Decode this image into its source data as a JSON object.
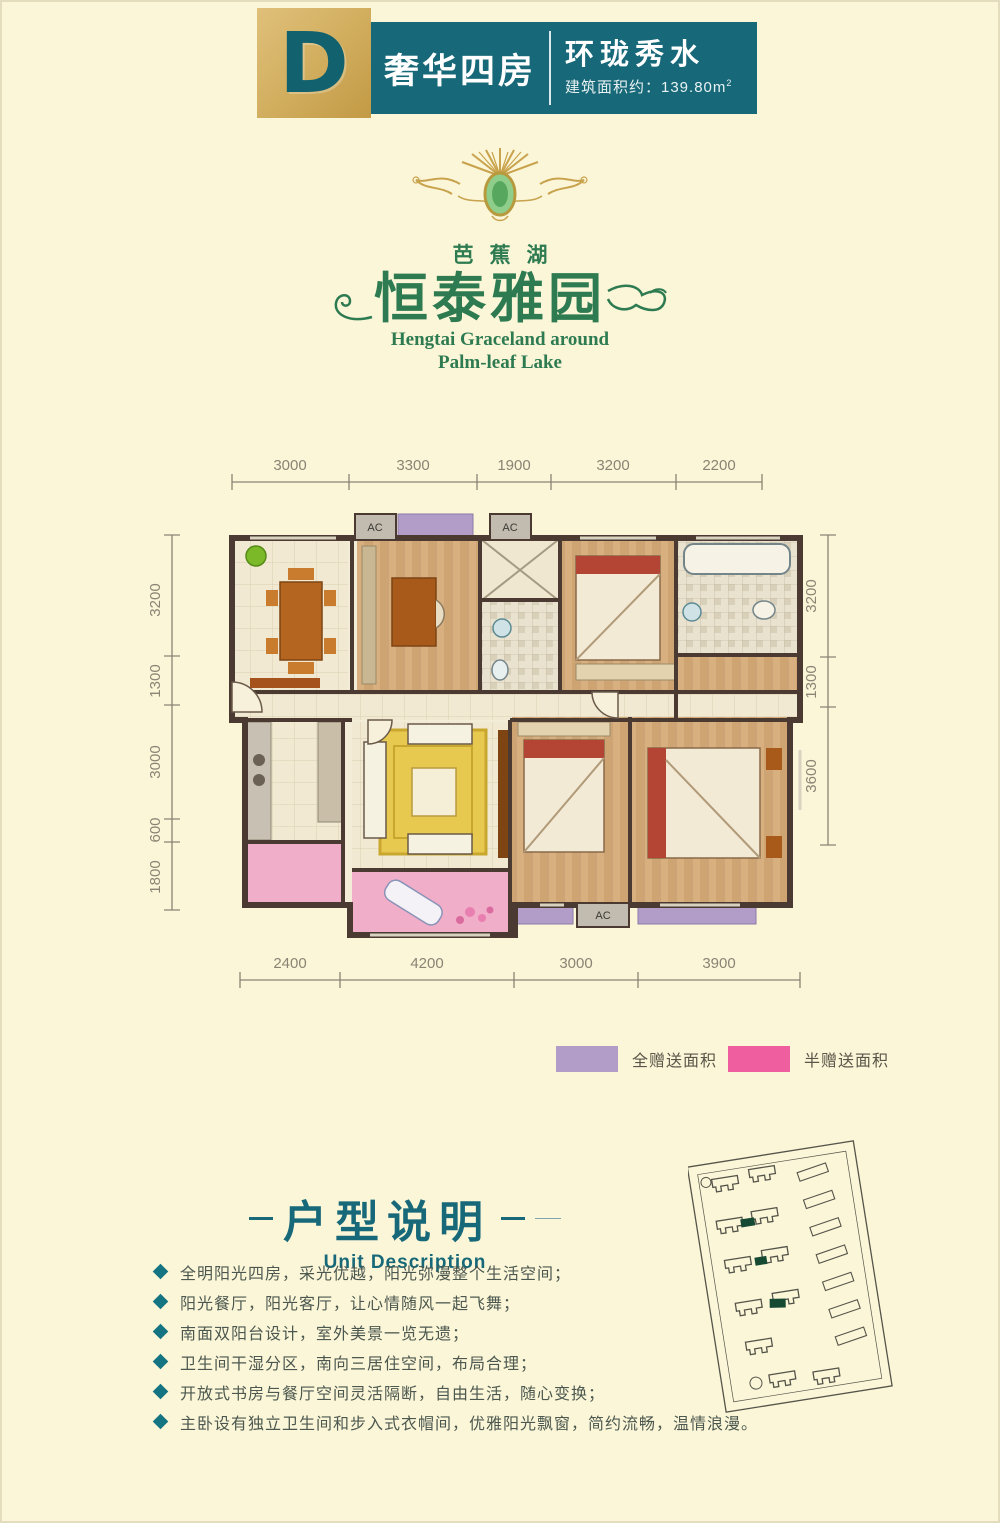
{
  "header": {
    "block_letter": "D",
    "unit_type": "奢华四房",
    "slogan": "环珑秀水",
    "area_label": "建筑面积约：139.80m",
    "area_sup": "2"
  },
  "logo": {
    "lake": "芭蕉湖",
    "name": "恒泰雅园",
    "en_line1": "Hengtai Graceland around",
    "en_line2": "Palm-leaf Lake"
  },
  "plan": {
    "ac_label": "AC",
    "dims": {
      "top": [
        "3000",
        "3300",
        "1900",
        "3200",
        "2200"
      ],
      "left": [
        "3200",
        "1300",
        "3000",
        "600",
        "1800"
      ],
      "right": [
        "3200",
        "1300",
        "3600"
      ],
      "bottom": [
        "2400",
        "4200",
        "3000",
        "3900"
      ]
    }
  },
  "legend": {
    "full_gift": {
      "label": "全赠送面积",
      "color": "#b29dc8"
    },
    "half_gift": {
      "label": "半赠送面积",
      "color": "#ef5fa0"
    }
  },
  "description": {
    "title": "户型说明",
    "subtitle": "Unit Description",
    "bullets": [
      "全明阳光四房，采光优越，阳光弥漫整个生活空间；",
      "阳光餐厅，阳光客厅，让心情随风一起飞舞；",
      "南面双阳台设计，室外美景一览无遗；",
      "卫生间干湿分区，南向三居住空间，布局合理；",
      "开放式书房与餐厅空间灵活隔断，自由生活，随心变换；",
      "主卧设有独立卫生间和步入式衣帽间，优雅阳光飘窗，简约流畅，温情浪漫。"
    ]
  },
  "colors": {
    "background": "#fbf6d8",
    "banner_teal": "#176878",
    "gold": "#d3b062",
    "logo_green": "#2e7b52",
    "wall": "#4a3a31",
    "gift_purple": "#b29dc8",
    "half_gift_pink": "#f1aec8",
    "legend_pink": "#ef5fa0",
    "dimension_gray": "#8b8374"
  }
}
